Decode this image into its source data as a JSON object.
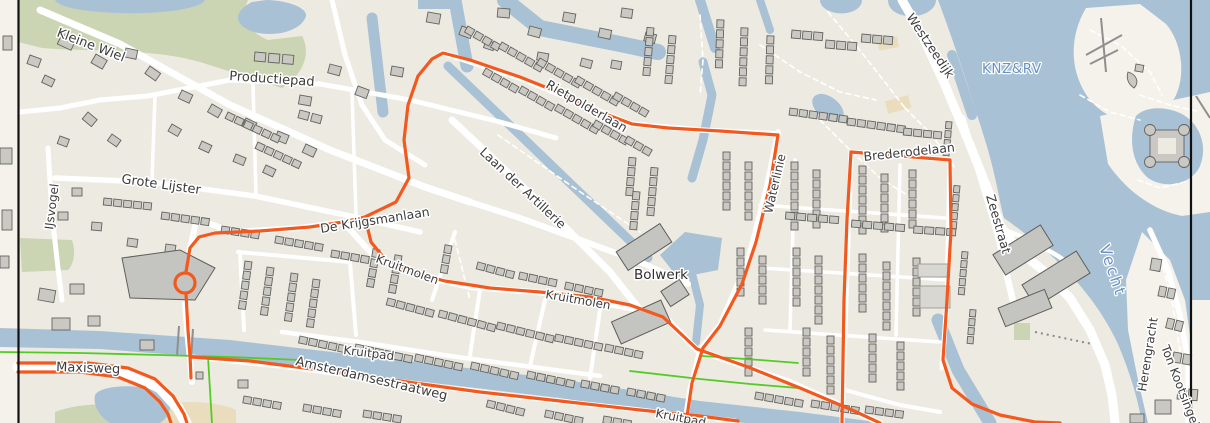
{
  "map": {
    "kind": "street-map-viewport",
    "labels": {
      "streets": {
        "kleine_wiel": "Kleine Wiel",
        "productiepad": "Productiepad",
        "grote_lijster": "Grote Lijster",
        "ijsvogel": "IJsvogel",
        "de_krijgsmanlaan": "De Krijgsmanlaan",
        "kruitmolen_w": "Kruitmolen",
        "kruitmolen_e": "Kruitmolen",
        "kruitpad_n": "Kruitpad",
        "kruitpad_s": "Kruitpad",
        "laan_der_artillerie": "Laan der Artillerie",
        "rietpolderlaan": "Rietpolderlaan",
        "waterlinie": "Waterlinie",
        "brederodelaan": "Brederodelaan",
        "zeestraat": "Zeestraat",
        "westzeedijk": "Westzeedijk",
        "herengracht": "Herengracht",
        "ton_kootsingel": "Ton Kootsingel",
        "maxisweg": "Maxisweg",
        "amsterdamsestraatweg": "Amsterdamsestraatweg"
      },
      "areas": {
        "bolwerk": "Bolwerk"
      },
      "water": {
        "knzrv": "KNZ&RV",
        "vecht": "Vecht"
      }
    },
    "colors": {
      "land": "#EDEAE1",
      "land_open": "#F4F2EB",
      "water": "#A9C1D4",
      "park": "#CBD5B4",
      "sand": "#E9DDBD",
      "building_fill": "#C9C8C3",
      "building_stroke": "#63635F",
      "road": "#FFFFFF",
      "route_primary": "#F2591F",
      "cycleway": "#53CB25",
      "frame": "#111111",
      "label": "#3D3D3D",
      "water_label": "#6992C1"
    }
  }
}
